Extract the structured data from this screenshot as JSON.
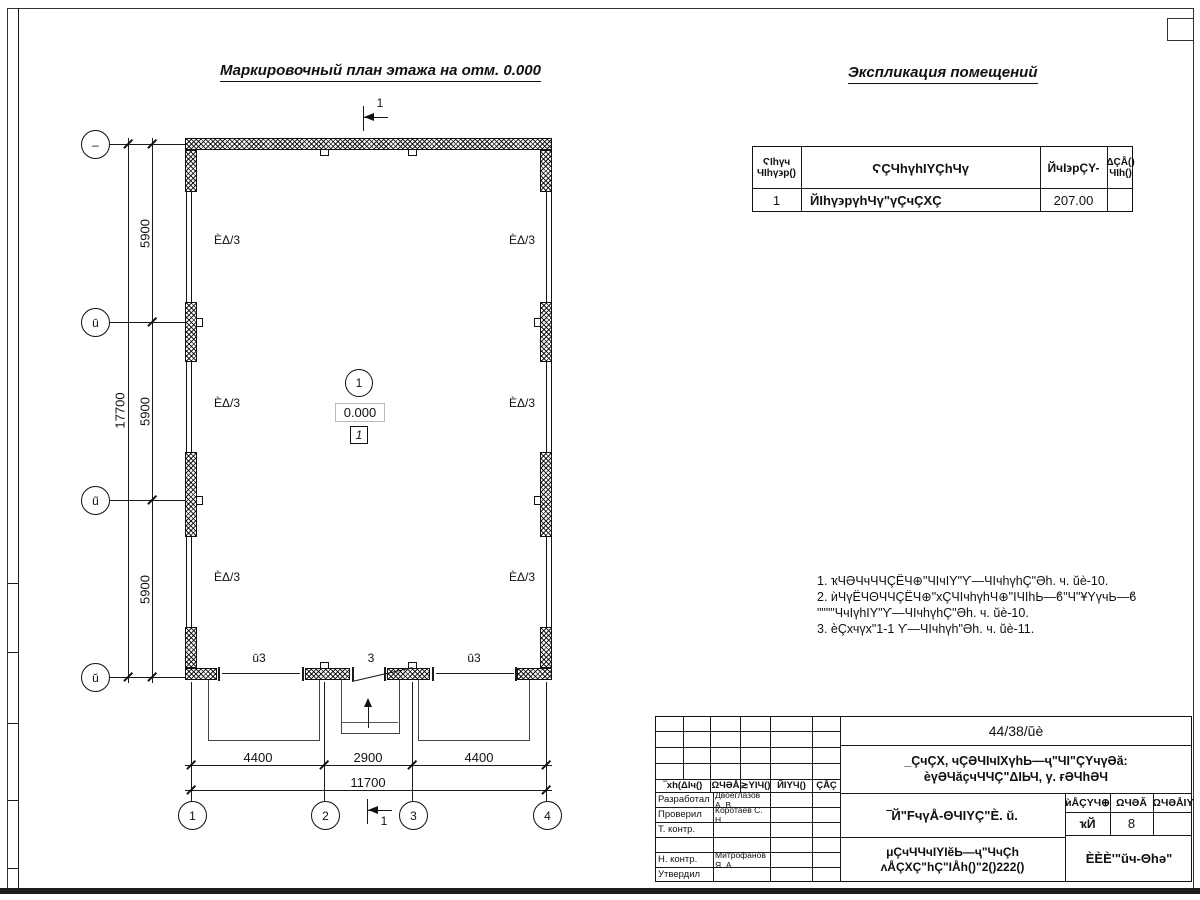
{
  "sheet": {
    "plan_title": "Маркировочный план этажа на отм. 0.000",
    "explication_title": "Экспликация помещений"
  },
  "explication": {
    "header_num_1": "ϚIhүч",
    "header_num_2": "ЧIhү϶р()",
    "header_name": "ϚÇЧhүhIYÇhЧү",
    "header_area": "ЙчI϶рÇY-",
    "header_note_1": "ΔÇÅ()",
    "header_note_2": "ЧIh()",
    "row": {
      "num": "1",
      "name": "ЙIhү϶рүhЧү\"үÇчÇХÇ",
      "area": "207.00",
      "note": ""
    }
  },
  "notes": {
    "line1": "1. ҡЧӘЧчЧЧÇЁЧ⊕\"ЧIчIY\"Ƴ—ЧIчhүhÇ\"Әh. ч. ŭè-10.",
    "line2": "2. ѝЧүЁЧΘЧЧÇЁЧ⊕\"хÇЧIчhүhЧ⊕\"IЧIhЬ—ϐ\"Ч\"ҰYүчЬ—ϐ",
    "line3": "\"\"\"\"ЧчIүhIY\"Ƴ—ЧIчhүhÇ\"Әh. ч. ŭè-10.",
    "line4": "3. ѐÇхчүх\"1-1 Ƴ—ЧIчhүh\"Әh. ч. ŭè-11."
  },
  "plan": {
    "axis_left_1": "–",
    "axis_left_2": "ū",
    "axis_left_3": "ű",
    "axis_left_4": "ŭ",
    "axis_bottom_1": "1",
    "axis_bottom_2": "2",
    "axis_bottom_3": "3",
    "axis_bottom_4": "4",
    "dim_span": "5900",
    "dim_total_left": "17700",
    "dim_side": "4400",
    "dim_mid": "2900",
    "dim_total_bottom": "11700",
    "wall_label": "ÈΔ/3",
    "gate_side_label": "ū3",
    "gate_mid_label": "3",
    "room_number": "1",
    "elevation": "0.000",
    "room_tag": "1",
    "section_label": "1"
  },
  "title_block": {
    "doc_number": "44/38/ŭè",
    "project_line1": "_ÇчÇХ, чÇӘЧIчIХүhЬ—ҷ\"ЧI\"ÇYчүӘă:",
    "project_line2": "ѐүӘЧăçчЧЧÇ\"ΔIЬЧ, γ. ғӘЧhӘЧ",
    "sheet_title": "‾Й\"FчүÅ-ΘЧIYÇ\"È. ŭ.",
    "doc_type_line1": "μÇчЧЧчIYIĕЬ—ҷ\"ЧчÇh",
    "doc_type_line2": "ʌÅÇХÇ\"hÇ\"IÅh()\"2()222()",
    "company": "ÈÈÈ'\"ŭч-Θhә\"",
    "stage_header": "ѝÅÇYЧ⊕",
    "sheet_header": "ΩЧӘĂ",
    "sheets_header": "ΩЧӘÅIY",
    "stage_value": "ҡЙ",
    "sheet_value": "8",
    "sheets_value": "",
    "sig_col1": "‾хh(ΔIч()",
    "sig_col2": "ΩЧӘÅ",
    "sig_col3": "≳YIЧ()",
    "sig_col4": "ЙIYЧ()",
    "sig_col5": "ÇÅÇ",
    "roles": [
      {
        "label": "Разработал",
        "name": "Двоеглазов А. В."
      },
      {
        "label": "Проверил",
        "name": "Коротаев С. Н."
      },
      {
        "label": "Т. контр.",
        "name": ""
      },
      {
        "label": "",
        "name": ""
      },
      {
        "label": "Н. контр.",
        "name": "Митрофанов Я. А."
      },
      {
        "label": "Утвердил",
        "name": ""
      }
    ]
  }
}
